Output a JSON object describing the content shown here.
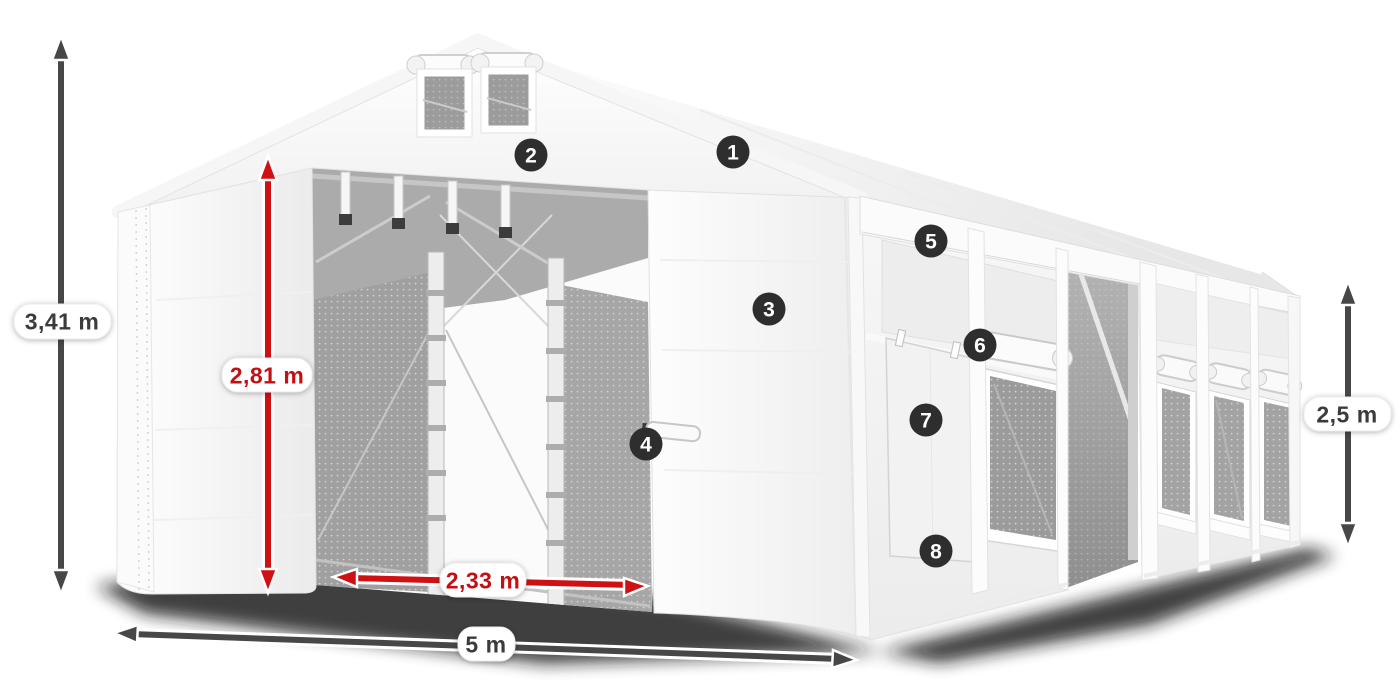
{
  "illustration": {
    "callouts": [
      "1",
      "2",
      "3",
      "4",
      "5",
      "6",
      "7",
      "8"
    ],
    "dimensions": {
      "overall_height": "3,41 m",
      "door_height": "2,81 m",
      "door_width": "2,33 m",
      "overall_width": "5 m",
      "side_height": "2,5 m"
    },
    "colors": {
      "dimension-gray": "#474747",
      "dimension-label-gray": "#3b3b3b",
      "dimension-red": "#d01114",
      "dimension-label-red": "#c50f12",
      "badge-bg": "#2e2e2e",
      "badge-text": "#ffffff",
      "tent-white": "#ffffff",
      "interior-gray": "#a5a5a5"
    }
  }
}
